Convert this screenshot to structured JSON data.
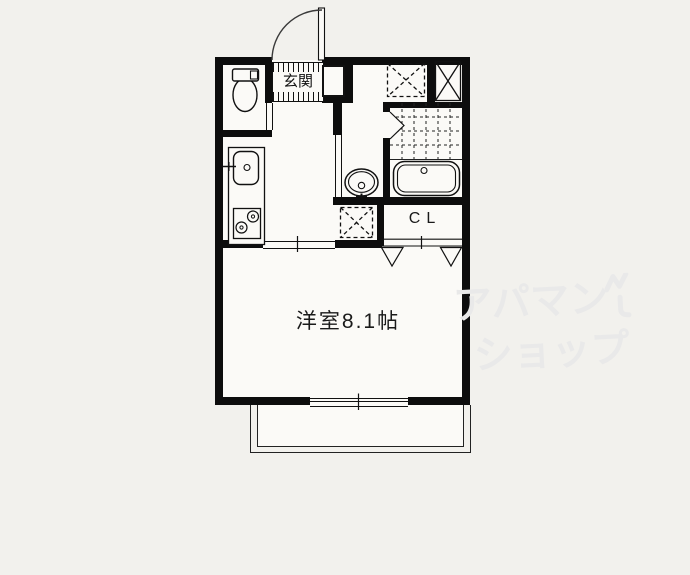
{
  "plan": {
    "type": "japanese-apartment-floor-plan",
    "labels": {
      "entrance": "玄関",
      "closet": "CL",
      "main_room": "洋室8.1帖"
    },
    "watermark": {
      "line1": "アパマン",
      "line2": "ショップ",
      "brand": "アパマンショップ",
      "color": "#e9e9e9"
    },
    "colors": {
      "wall": "#0d0d0d",
      "line": "#1a1a1a",
      "paper": "#f2f1ed",
      "floor": "#fbfaf7"
    },
    "fixture_names": [
      "entrance-swing-door",
      "shoe-cabinet",
      "toilet",
      "kitchen-counter",
      "kitchen-sink",
      "gas-stove",
      "washbasin",
      "washing-machine-space",
      "bathtub",
      "bathroom-tile-floor",
      "bathroom-folding-door",
      "meter-box",
      "pipe-space",
      "closet-bifold-doors",
      "sliding-door",
      "sliding-window",
      "balcony"
    ]
  }
}
